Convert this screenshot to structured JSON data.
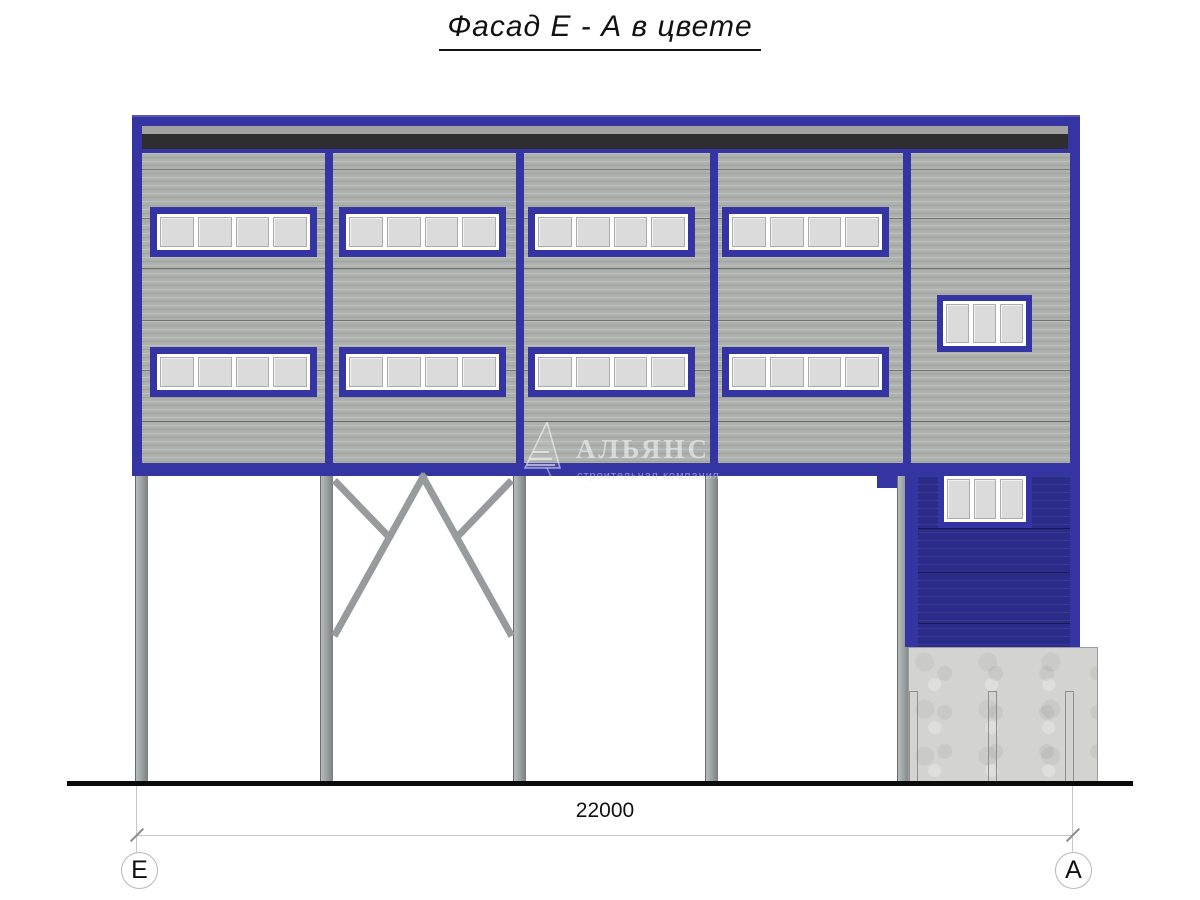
{
  "title": "Фасад Е - А в цвете",
  "watermark": {
    "name": "АЛЬЯНС",
    "tagline": "строительная компания"
  },
  "dimension": {
    "value": "22000"
  },
  "grid_axes": {
    "left": "Е",
    "right": "А"
  },
  "colors": {
    "frame_blue": "#3434A2",
    "annex_navy": "#2B2B8A",
    "wall_gray": "#ADB0AD",
    "parapet_gray": "#A2A2A2",
    "parapet_dark": "#2E2E30",
    "pane_gray": "#DBDBDB",
    "column_gray": "#9AA0A0",
    "concrete_gray": "#D3D3D1",
    "ground_black": "#0B0B0B"
  },
  "facade": {
    "strip_window_rows": 2,
    "strips_per_row": 4,
    "panes_per_strip": 4,
    "small_windows": 2,
    "panes_per_small_window": 3,
    "column_count": 5
  }
}
